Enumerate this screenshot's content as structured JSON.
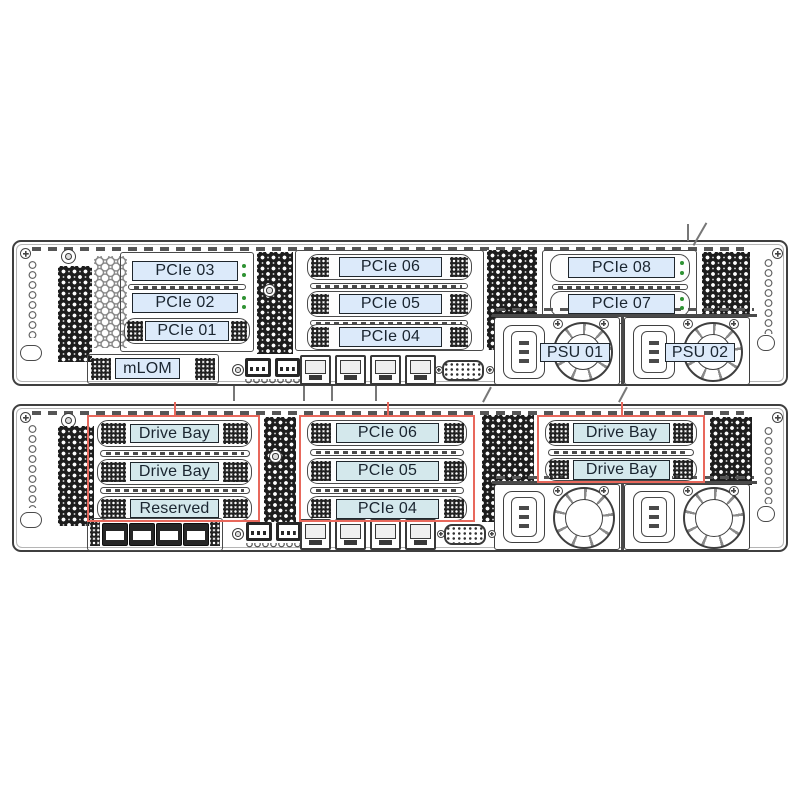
{
  "figure": {
    "highlight_color": "#e8685c",
    "label_fill_top": "#dceafa",
    "label_fill_bottom": "#d4e8ec",
    "label_text_color": "#1a2530",
    "line_color": "#3f3f3f",
    "led_color": "#2f9233"
  },
  "chassis_top": {
    "riser1_slots": [
      "PCIe 03",
      "PCIe 02",
      "PCIe 01"
    ],
    "riser2_slots": [
      "PCIe 06",
      "PCIe 05",
      "PCIe 04"
    ],
    "riser3_slots": [
      "PCIe 08",
      "PCIe 07"
    ],
    "mlom_label": "mLOM",
    "psu_labels": [
      "PSU 01",
      "PSU 02"
    ]
  },
  "chassis_bottom": {
    "bay_group1_slots": [
      "Drive Bay",
      "Drive Bay",
      "Reserved"
    ],
    "riser2_slots": [
      "PCIe 06",
      "PCIe 05",
      "PCIe 04"
    ],
    "bay_group3_slots": [
      "Drive Bay",
      "Drive Bay"
    ]
  }
}
